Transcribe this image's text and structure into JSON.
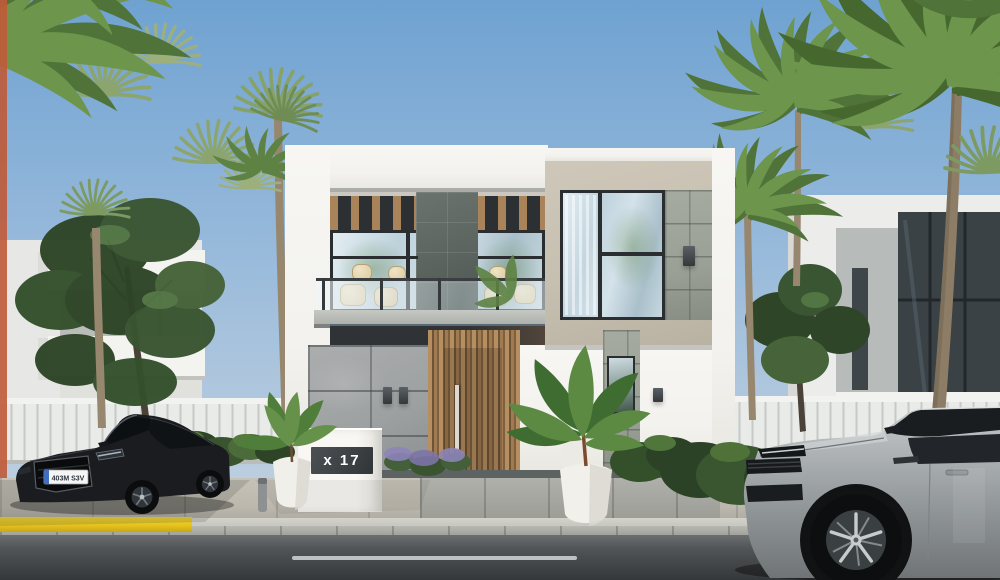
{
  "scene": {
    "description": "3D exterior render of a modern two-storey villa with palm trees, a black sedan and a silver SUV parked on the street",
    "house_number": "x 17",
    "license_plate": "403M S3V"
  },
  "colors": {
    "sky_top": "#6fa2d1",
    "sky_mid": "#93b7da",
    "sky_horizon": "#c9d7e1",
    "villa_white": "#f3f2ee",
    "villa_beige": "#c7c0b1",
    "stone_dark": "#5c645f",
    "stone_light": "#9aa096",
    "stone_ground": "#9ea1a2",
    "wood": "#a9835a",
    "window_frame": "#2b2e30",
    "glass": "#cddde6",
    "fence_white": "#e9ebe9",
    "hedge_green": "#3a5630",
    "palm_green": "#6d954c",
    "palm_fan": "#8ca56e",
    "trunk_brown": "#97876f",
    "pavement": "#bcb8ae",
    "curb": "#c9c9c2",
    "curb_yellow": "#e6c41f",
    "road_asphalt": "#515558",
    "car_black": "#1a1c1f",
    "car_silver": "#aeb3b5",
    "terracotta_edge": "#c05a38",
    "plaque_dark": "#3c4144"
  }
}
